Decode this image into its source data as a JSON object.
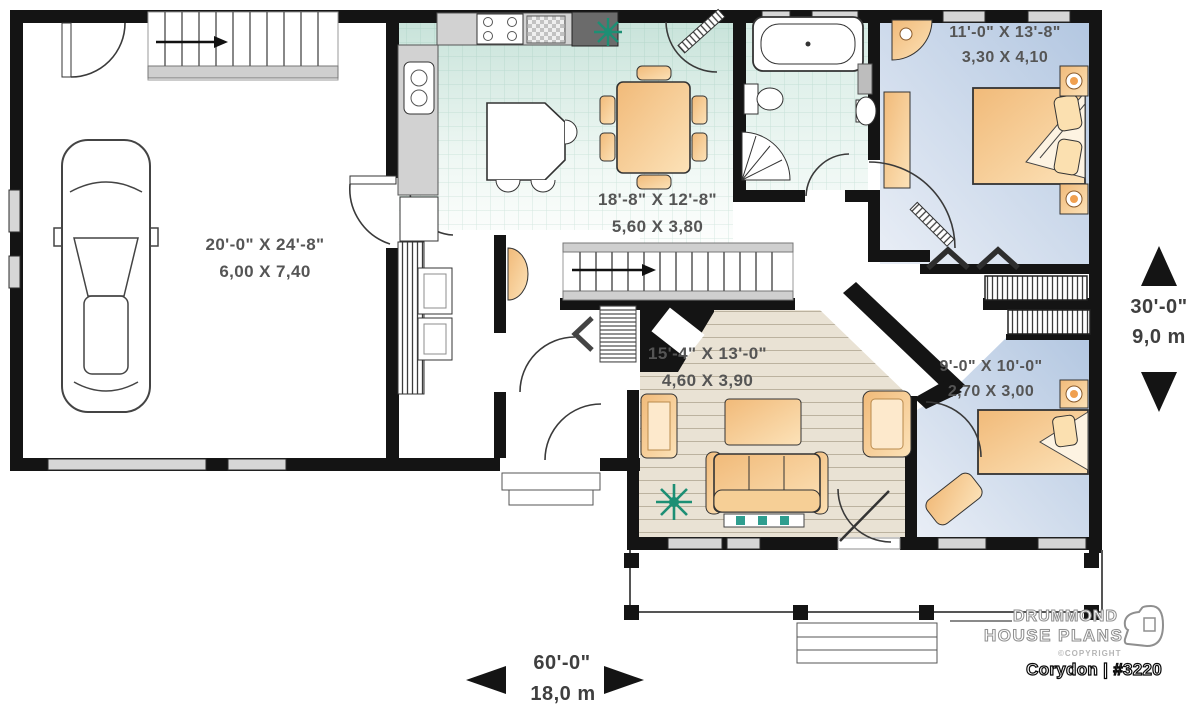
{
  "plan_type": "first-floor-plan",
  "rooms": [
    {
      "id": "garage",
      "imperial": "20'-0\" X 24'-8\"",
      "metric": "6,00 X 7,40"
    },
    {
      "id": "kitchen-dining",
      "imperial": "18'-8\" X 12'-8\"",
      "metric": "5,60 X 3,80"
    },
    {
      "id": "bedroom-1",
      "imperial": "11'-0\" X 13'-8\"",
      "metric": "3,30 X 4,10"
    },
    {
      "id": "living-room",
      "imperial": "15'-4\" X 13'-0\"",
      "metric": "4,60 X 3,90"
    },
    {
      "id": "bedroom-2",
      "imperial": "9'-0\" X 10'-0\"",
      "metric": "2,70 X 3,00"
    }
  ],
  "overall_dimensions": {
    "depth_imperial": "30'-0\"",
    "depth_metric": "9,0 m",
    "width_imperial": "60'-0\"",
    "width_metric": "18,0 m"
  },
  "branding": {
    "name_line1": "DRUMMOND",
    "name_line2": "HOUSE PLANS",
    "copyright": "©COPYRIGHT",
    "plan_name": "Corydon | #3220"
  },
  "icons": {
    "up_arrow": "direction-up-triangle",
    "down_arrow": "direction-down-triangle",
    "left_arrow": "direction-left-triangle",
    "right_arrow": "direction-right-triangle",
    "stairs_arrow": "stairs-up-arrow",
    "plants": "houseplant-starburst"
  },
  "colors": {
    "walls": "#141414",
    "kitchen_floor": "#c8e3da",
    "bathroom_floor": "#d7ece5",
    "bedroom_floor": "#b3c7e1",
    "living_floor": "#e9e2d4",
    "furniture": "#f1ba79",
    "plant_green": "#1d8f74",
    "window_gray": "#d6d6d6"
  }
}
